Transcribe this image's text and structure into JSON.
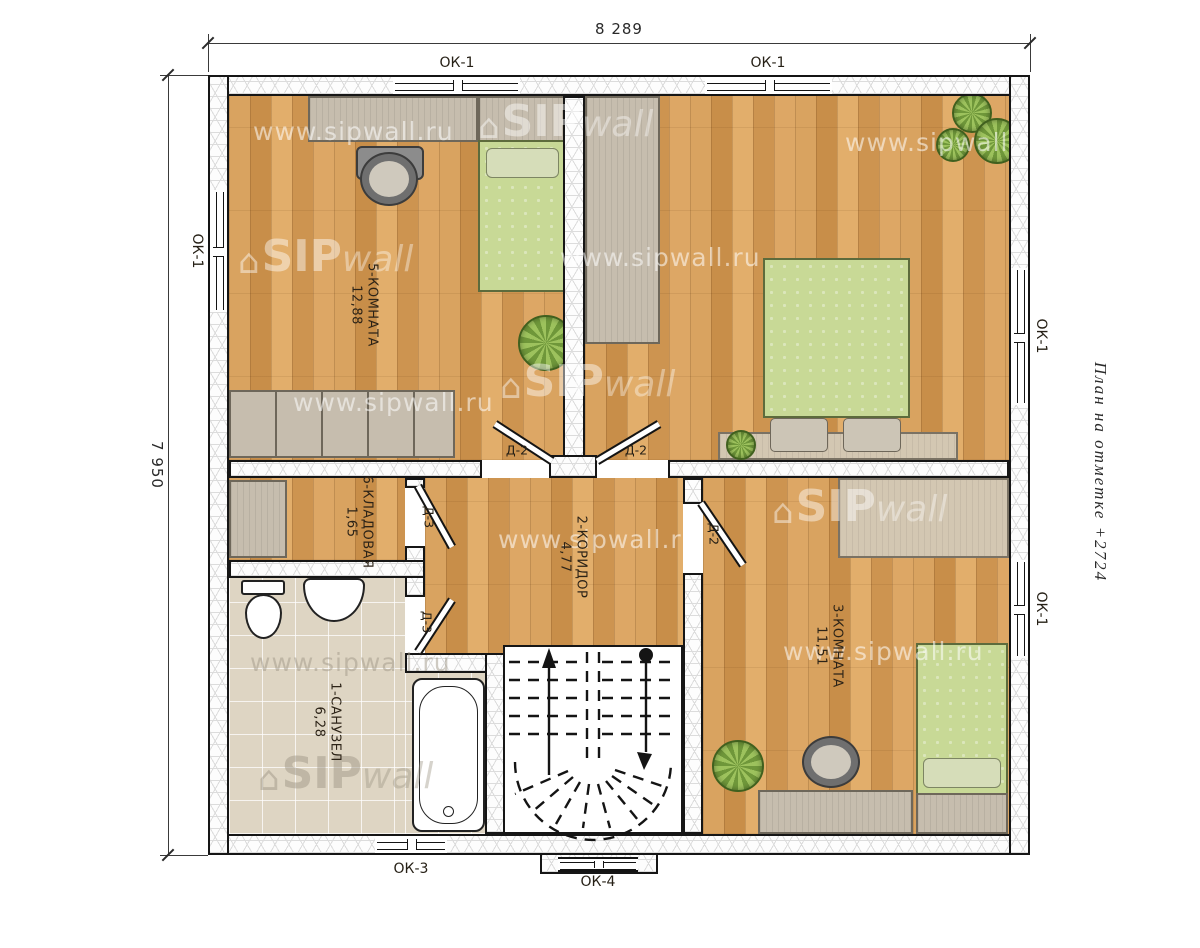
{
  "drawing": {
    "title_vertical": "План на отметке +2724",
    "dim_width": "8 289",
    "dim_height": "7 950"
  },
  "windows": {
    "ok1": "ОК-1",
    "ok3": "ОК-3",
    "ok4": "ОК-4"
  },
  "doors": {
    "d2": "Д-2",
    "d3": "Д-3"
  },
  "rooms": {
    "bathroom": {
      "name": "1-САНУЗЕЛ",
      "area": "6,28"
    },
    "corridor": {
      "name": "2-КОРИДОР",
      "area": "4,77"
    },
    "room3": {
      "name": "3-КОМНАТА",
      "area": "11,51"
    },
    "room5": {
      "name": "5-КОМНАТА",
      "area": "12,88"
    },
    "storage": {
      "name": "6-КЛАДОВАЯ",
      "area": "1,65"
    }
  },
  "watermark": {
    "url": "www.sipwall.ru",
    "house": "⌂",
    "sip": "SIP",
    "wall": "wall"
  },
  "colors": {
    "wood": "#d49a55",
    "bed_green": "#c8d996",
    "tile": "#ded5c3",
    "furniture_gray": "#c6bdae",
    "line": "#161616"
  }
}
